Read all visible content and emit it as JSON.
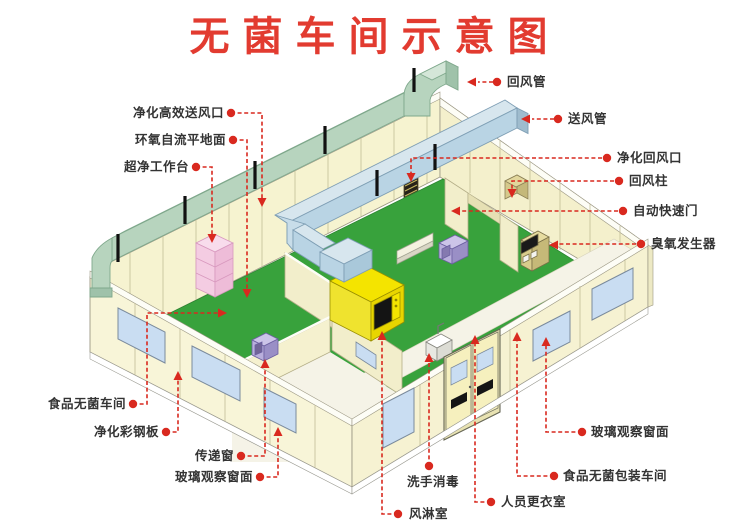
{
  "title": "无菌车间示意图",
  "colors": {
    "title_red": "#e23b30",
    "leader_red": "#d9291f",
    "label_text": "#333333",
    "wall_cream": "#f8f5d8",
    "floor_green": "#38a23c",
    "return_duct_green": "#b7d4be",
    "supply_duct_blue": "#b9d4e4",
    "air_shower_yellow": "#f4e400",
    "workbench_pink": "#f4cce2",
    "pass_box_purple": "#b9afdc",
    "cabinet_tan": "#d8cc8c",
    "window_blue": "#c9ddf2"
  },
  "labels": {
    "supply_outlet": "净化高效送风口",
    "epoxy_floor": "环氧自流平地面",
    "clean_bench": "超净工作台",
    "return_duct": "回风管",
    "supply_duct": "送风管",
    "return_grille": "净化回风口",
    "return_column": "回风柱",
    "auto_door": "自动快速门",
    "ozone_generator": "臭氧发生器",
    "food_workshop": "食品无菌车间",
    "steel_panel": "净化彩钢板",
    "pass_window": "传递窗",
    "observation_window_left": "玻璃观察窗面",
    "hand_wash": "洗手消毒",
    "air_shower": "风淋室",
    "changing_room": "人员更衣室",
    "observation_window_right": "玻璃观察窗面",
    "packaging_workshop": "食品无菌包装车间"
  }
}
